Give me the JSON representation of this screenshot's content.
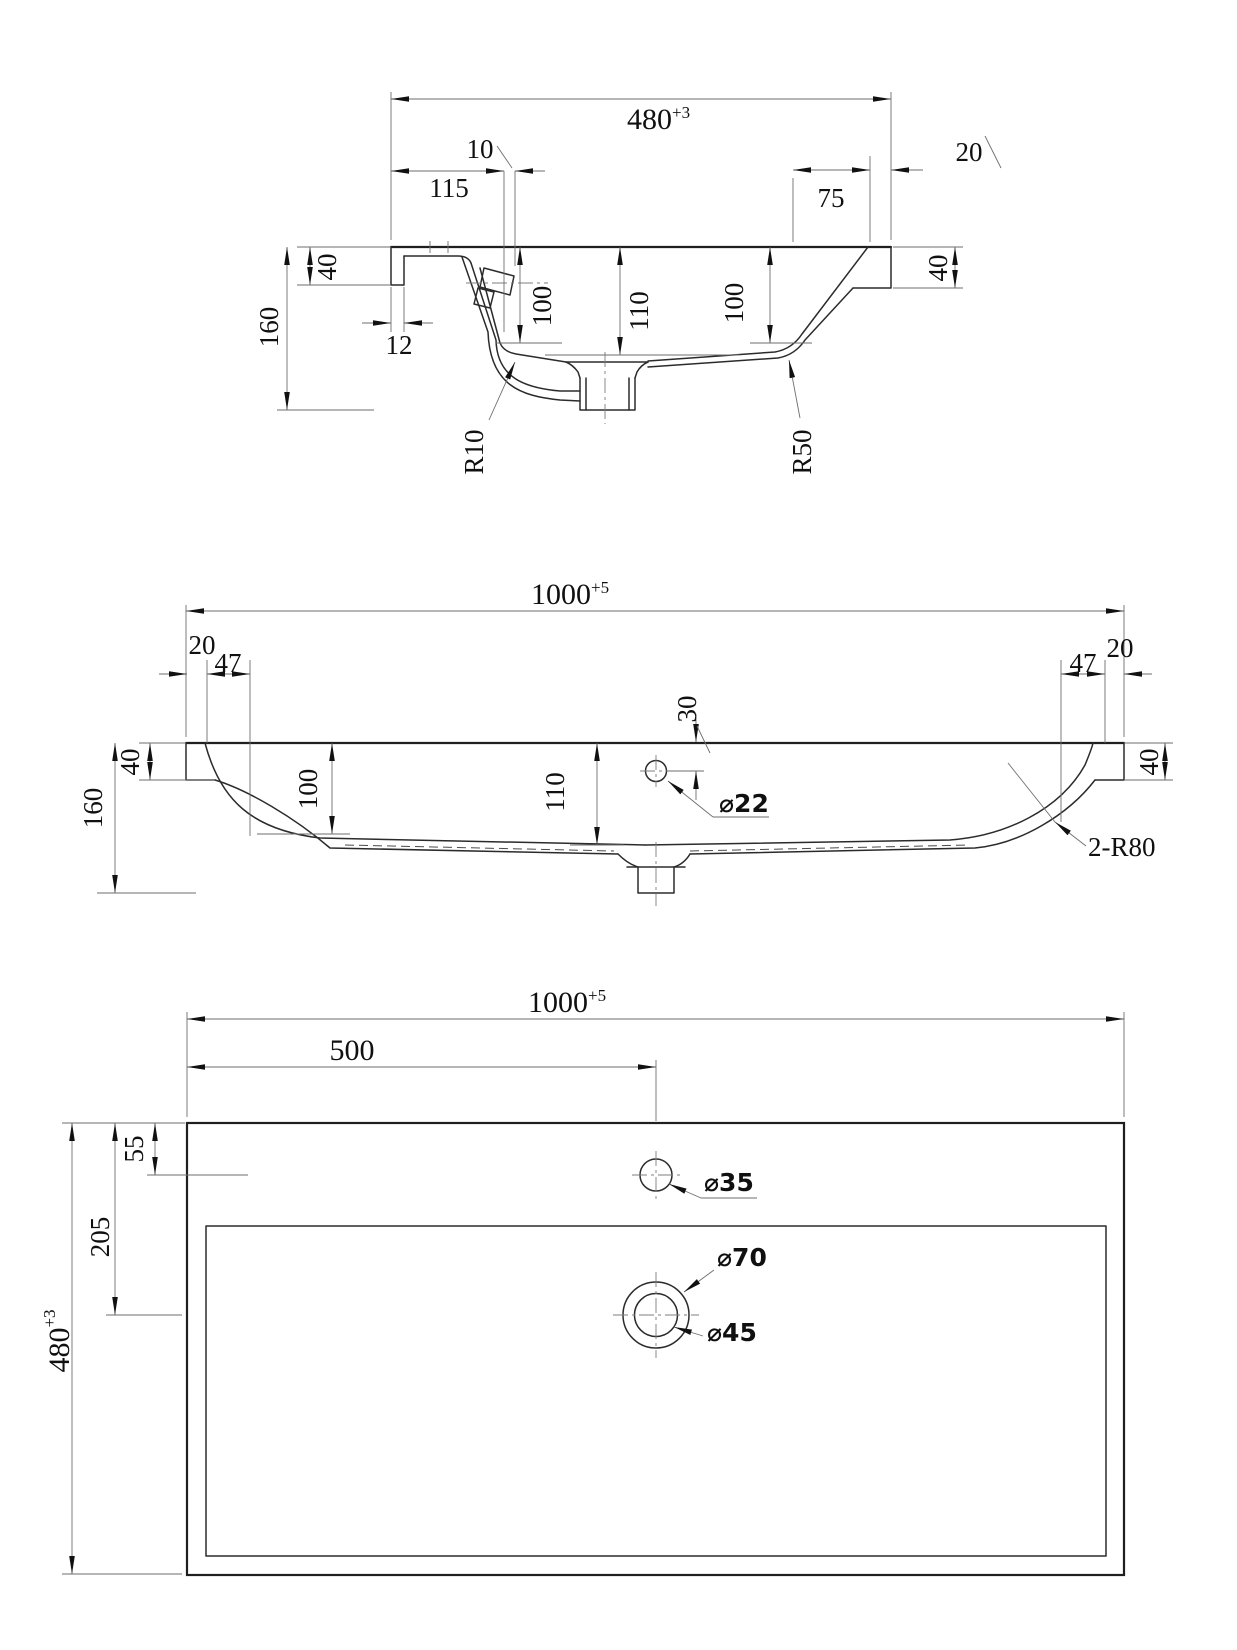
{
  "drawing": {
    "side_view": {
      "overall_width": "480",
      "overall_width_tol": "+3",
      "dim_10": "10",
      "dim_115": "115",
      "dim_20": "20",
      "dim_75": "75",
      "dim_40_left": "40",
      "dim_160": "160",
      "dim_12": "12",
      "dim_100_left": "100",
      "dim_110": "110",
      "dim_100_right": "100",
      "dim_40_right": "40",
      "radius_inner": "R10",
      "radius_outer": "R50"
    },
    "front_view": {
      "overall_width": "1000",
      "overall_width_tol": "+5",
      "dim_20_left": "20",
      "dim_47_left": "47",
      "dim_47_right": "47",
      "dim_20_right": "20",
      "dim_40_left": "40",
      "dim_160": "160",
      "dim_100": "100",
      "dim_110": "110",
      "dim_30": "30",
      "hole_dia": "⌀22",
      "corner_radius": "2-R80",
      "dim_40_right": "40"
    },
    "plan_view": {
      "overall_width": "1000",
      "overall_width_tol": "+5",
      "dim_500": "500",
      "dim_55": "55",
      "dim_205": "205",
      "overall_depth": "480",
      "overall_depth_tol": "+3",
      "faucet_hole_dia": "⌀35",
      "drain_outer_dia": "⌀70",
      "drain_inner_dia": "⌀45"
    }
  }
}
